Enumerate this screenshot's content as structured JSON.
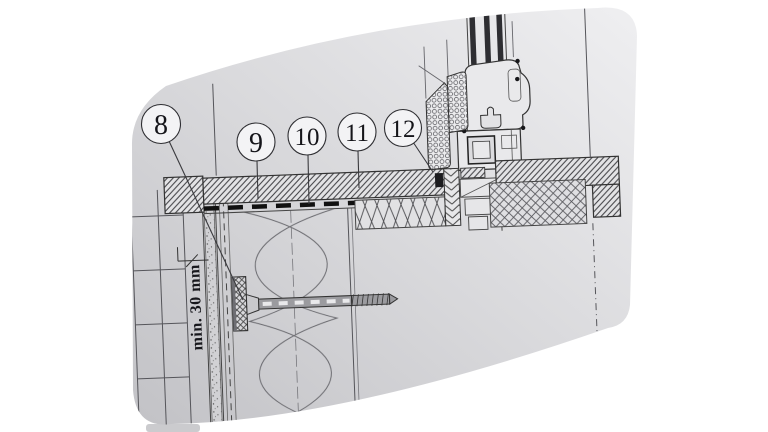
{
  "figure": {
    "dimension_note": "min. 30 mm",
    "callouts": [
      {
        "label": "8"
      },
      {
        "label": "9"
      },
      {
        "label": "10"
      },
      {
        "label": "11"
      },
      {
        "label": "12"
      }
    ],
    "colors": {
      "page_background": "#ffffff",
      "sheet_dark": "#c3c3c7",
      "sheet_mid": "#d7d7da",
      "sheet_light": "#eeeeef",
      "line": "#333333",
      "dark_fill": "#2e2e2e",
      "callout_fill": "#f3f3f5"
    }
  }
}
